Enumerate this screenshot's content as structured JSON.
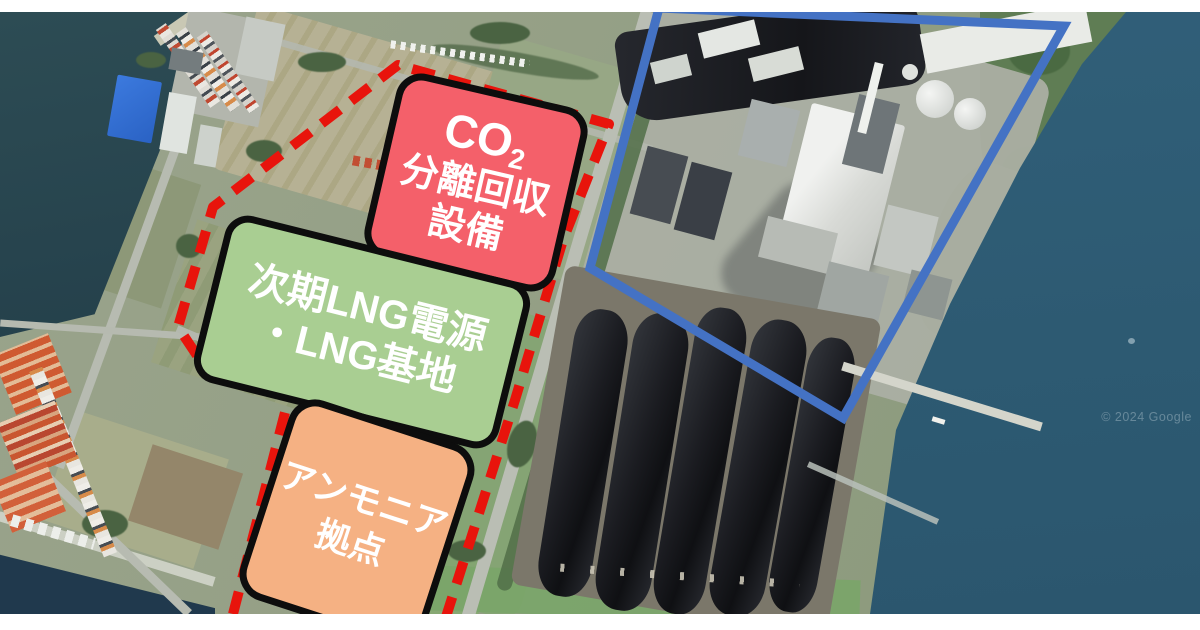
{
  "map": {
    "watermark": "© 2024 Google",
    "labels": {
      "co2": {
        "prefix": "CO",
        "subscript": "2",
        "line2": "分離回収",
        "line3": "設備"
      },
      "lng": {
        "line1": "次期LNG電源",
        "line2": "・LNG基地"
      },
      "ammonia": {
        "line1": "アンモニア",
        "line2": "拠点"
      }
    },
    "colors": {
      "co2_fill": "#f4606a",
      "lng_fill": "#a9ce92",
      "ammonia_fill": "#f5b183",
      "red_boundary": "#e8140c",
      "blue_boundary": "#4472c4"
    }
  }
}
